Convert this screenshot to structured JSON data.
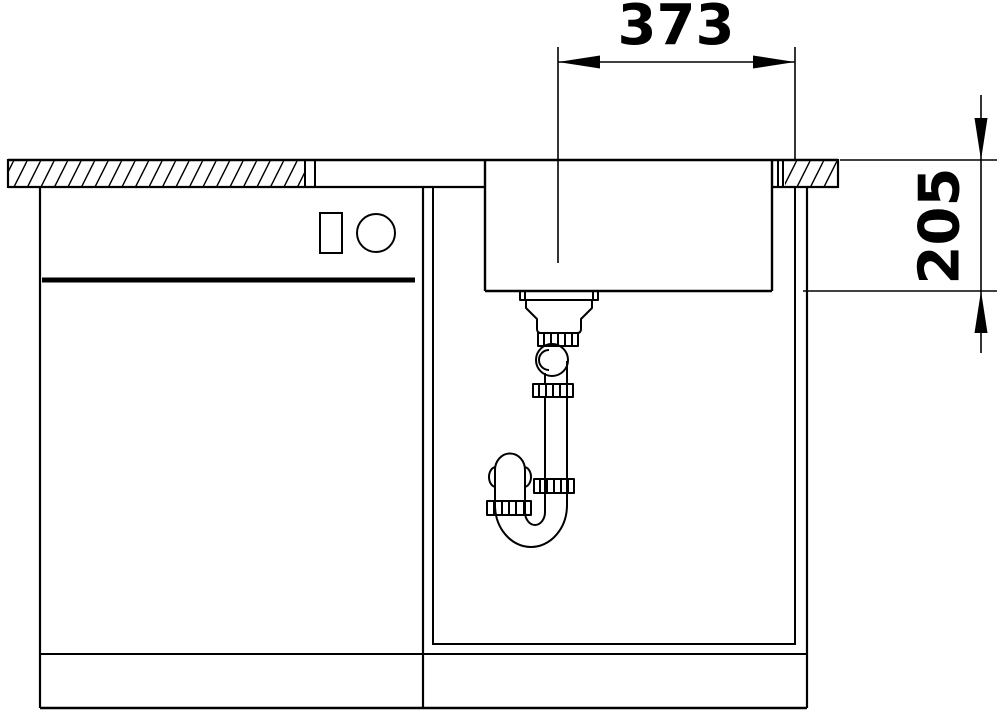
{
  "diagram": {
    "dimensions": {
      "width_mm": {
        "label": "373"
      },
      "depth_mm": {
        "label": "205"
      }
    },
    "colors": {
      "line": "#000000",
      "background": "#ffffff"
    }
  }
}
